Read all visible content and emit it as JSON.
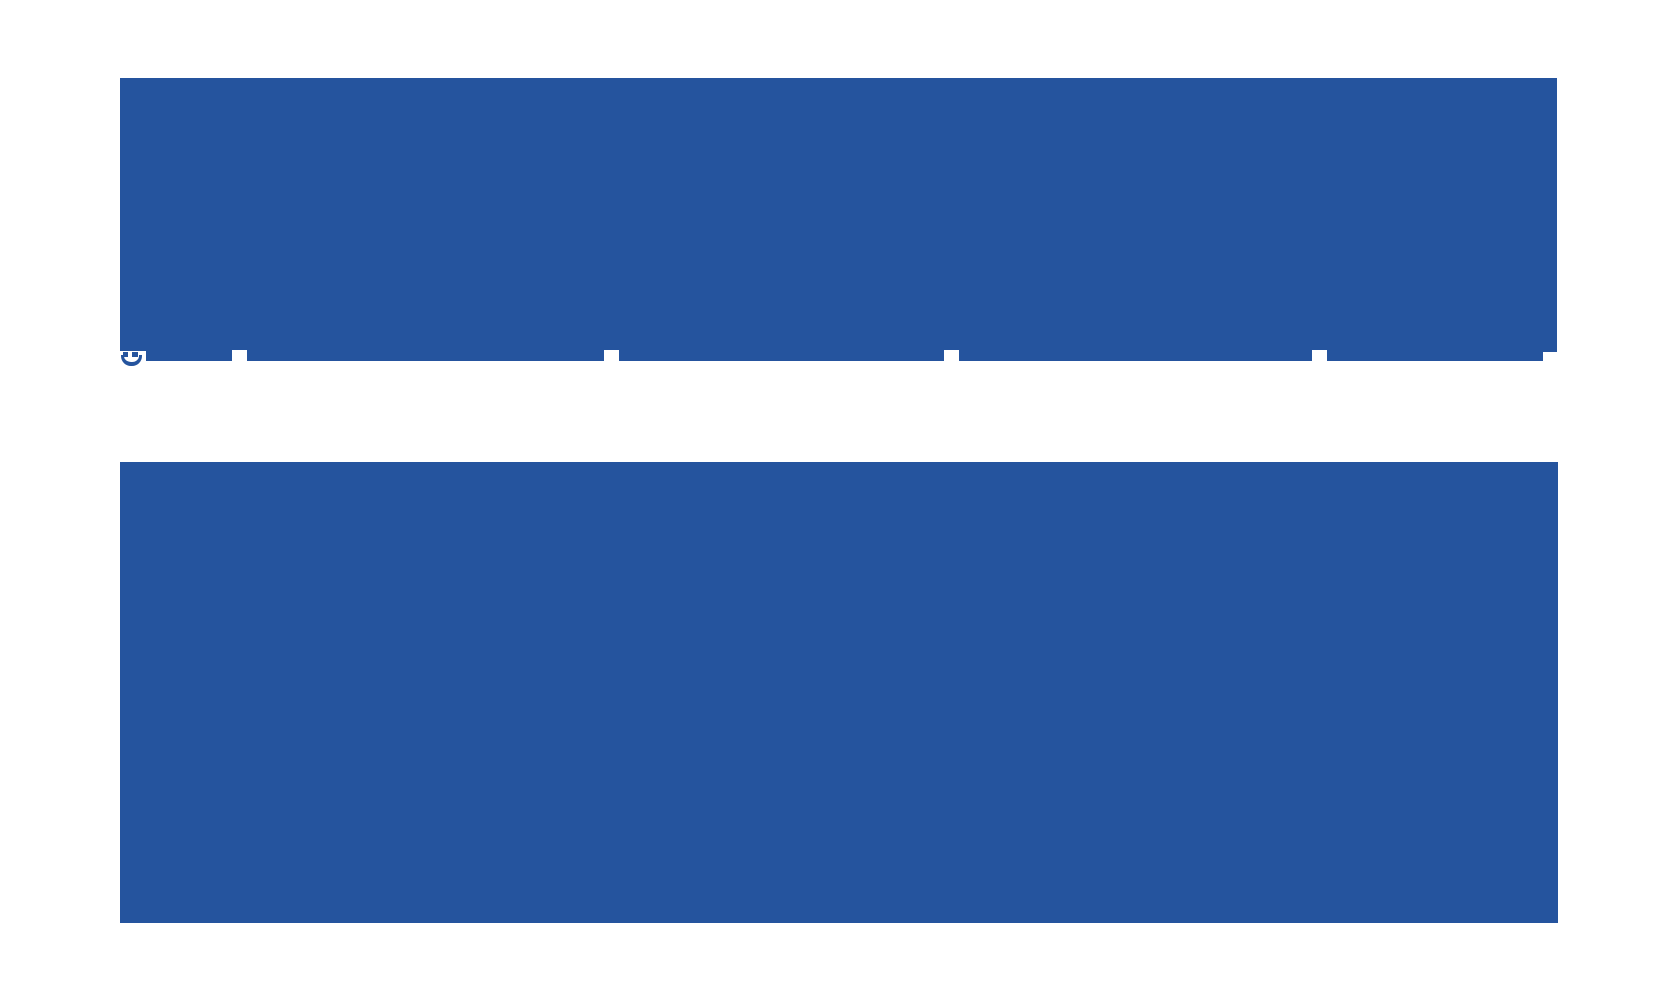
{
  "palette": {
    "block_blue": "#25549e",
    "background_white": "#ffffff"
  },
  "content": {
    "top_block": "",
    "bottom_block": "",
    "glyph_icon": "smile-glyph-icon"
  }
}
